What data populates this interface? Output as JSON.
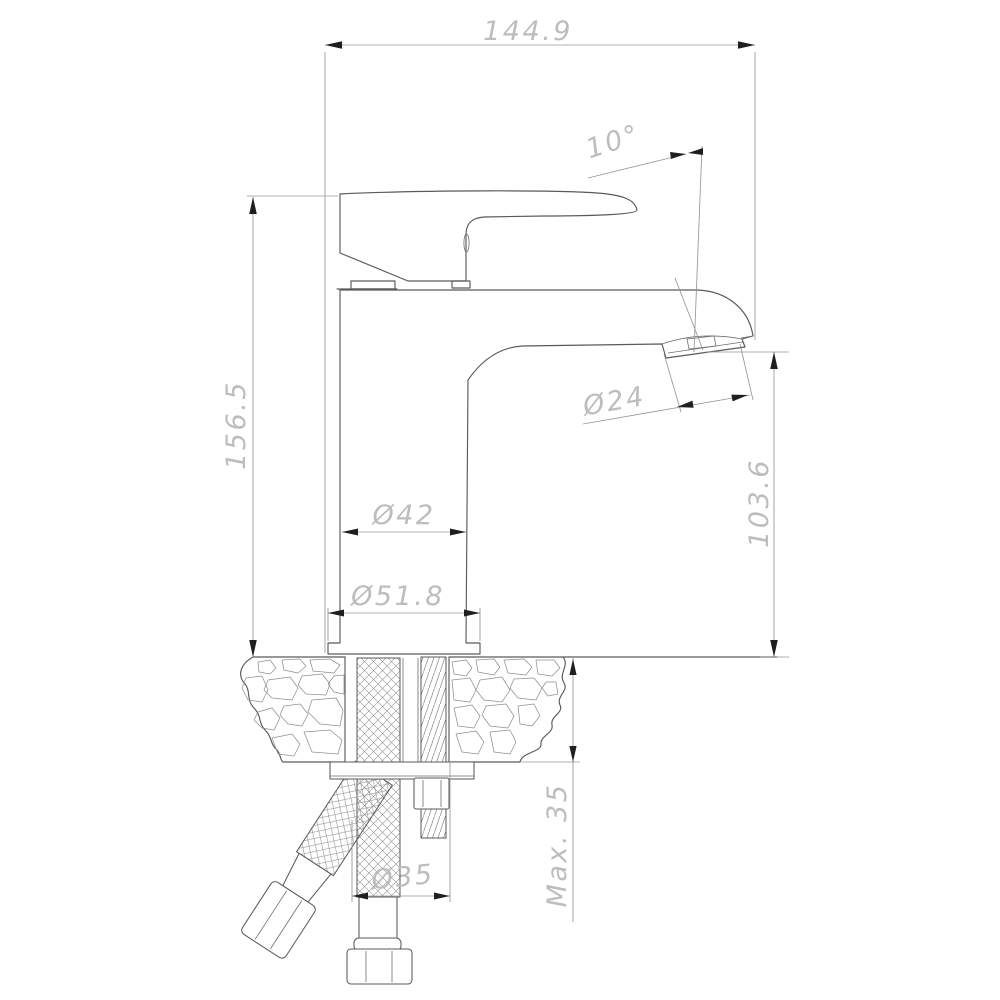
{
  "page": {
    "background": "#ffffff",
    "outline_color": "#5a5a5a",
    "dimension_line_color": "#969696",
    "dimension_text_color": "#bdbdbd",
    "arrow_color": "#1f1f1f"
  },
  "drawing": {
    "subject": "single-hole basin mixer faucet side elevation with deck mounting cross-section"
  },
  "dimensions": {
    "overall_width": {
      "label": "144.9"
    },
    "total_height": {
      "label": "156.5"
    },
    "spout_angle": {
      "label": "10°"
    },
    "aerator_diameter": {
      "label": "Ø24"
    },
    "spout_outlet_height": {
      "label": "103.6"
    },
    "body_diameter": {
      "label": "Ø42"
    },
    "base_diameter": {
      "label": "Ø51.8"
    },
    "max_deck_thickness": {
      "label": "Max. 35"
    },
    "mounting_hole_diameter": {
      "label": "Ø35"
    }
  }
}
